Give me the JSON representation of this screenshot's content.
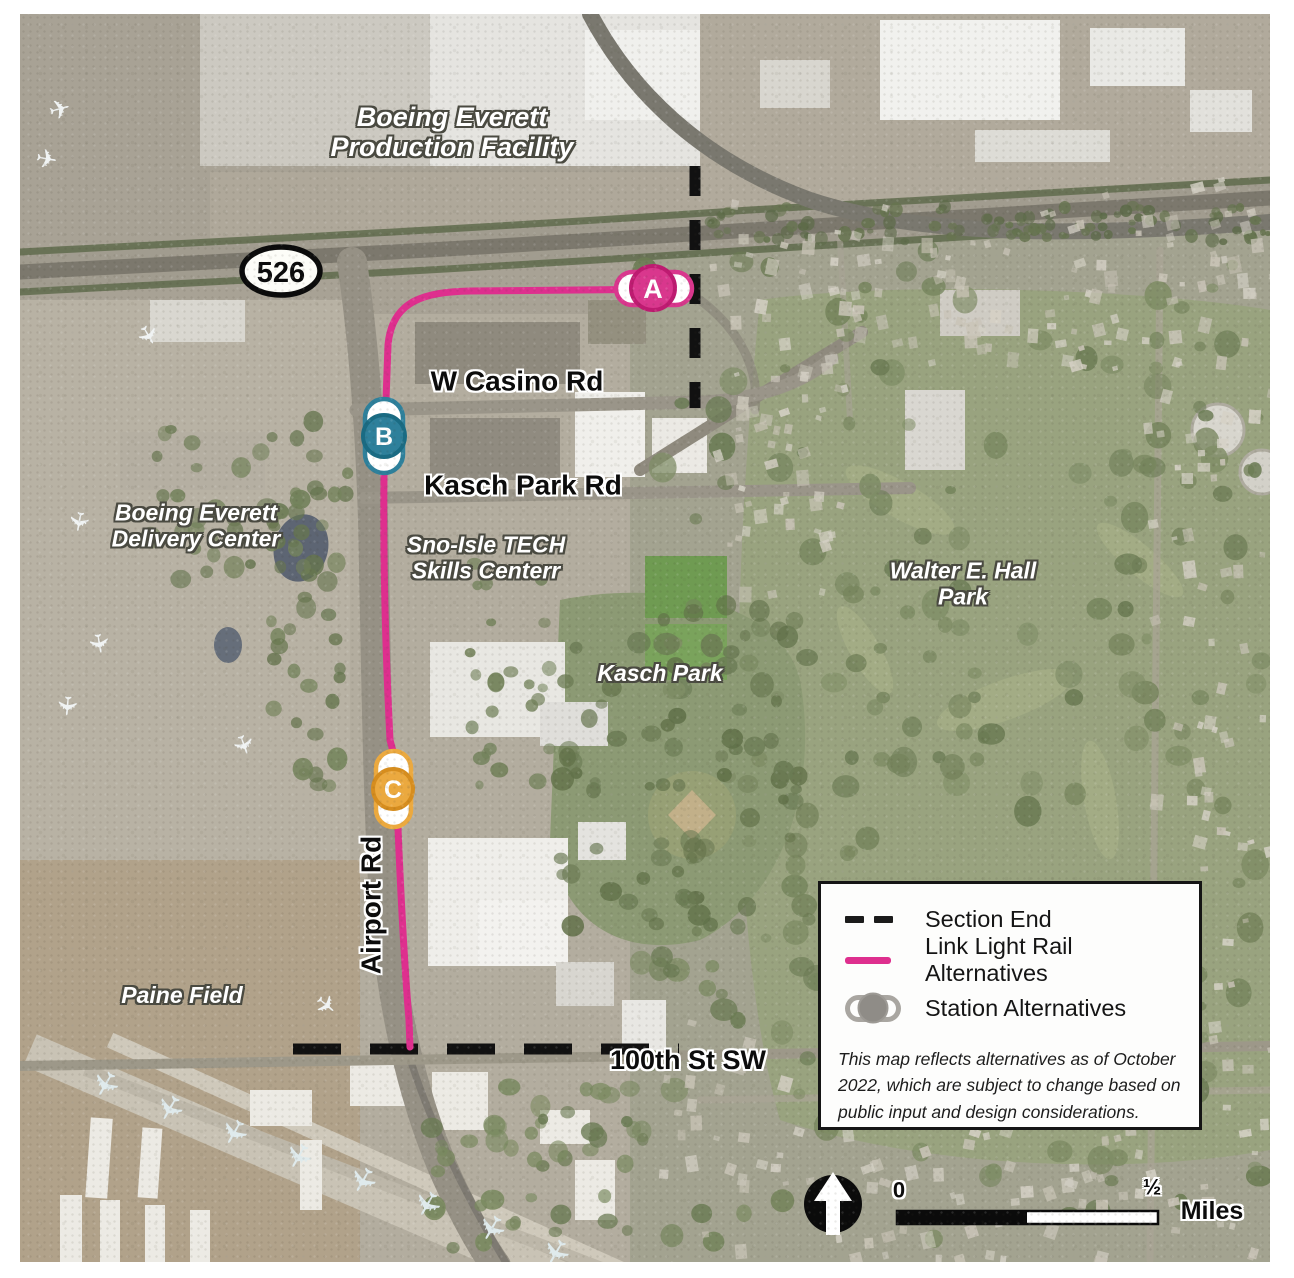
{
  "map": {
    "place_labels": {
      "boeing_production": "Boeing Everett\nProduction Facility",
      "boeing_delivery": "Boeing Everett\nDelivery Center",
      "sno_isle": "Sno-Isle TECH\nSkills Centerr",
      "kasch_park": "Kasch Park",
      "walter_hall": "Walter E. Hall\nPark",
      "paine_field": "Paine Field"
    },
    "road_labels": {
      "w_casino": "W Casino Rd",
      "kasch_park_rd": "Kasch Park Rd",
      "airport_rd": "Airport Rd",
      "hundredth_st": "100th St SW"
    },
    "route_shield": "526",
    "route_color": "#DE2F8E",
    "section_end_color": "#111111",
    "stations": [
      {
        "id": "A",
        "color": "#D9378D",
        "ring": "#BE1B71"
      },
      {
        "id": "B",
        "color": "#2E809B",
        "ring": "#1A6B83"
      },
      {
        "id": "C",
        "color": "#EBA93F",
        "ring": "#D68D1E"
      }
    ]
  },
  "legend": {
    "items": [
      {
        "label": "Section End"
      },
      {
        "label": "Link Light Rail Alternatives"
      },
      {
        "label": "Station Alternatives"
      }
    ],
    "note": "This map reflects alternatives as of October 2022, which are subject to change based on public input and design considerations."
  },
  "scale_bar": {
    "start": "0",
    "half": "½",
    "units": "Miles"
  }
}
